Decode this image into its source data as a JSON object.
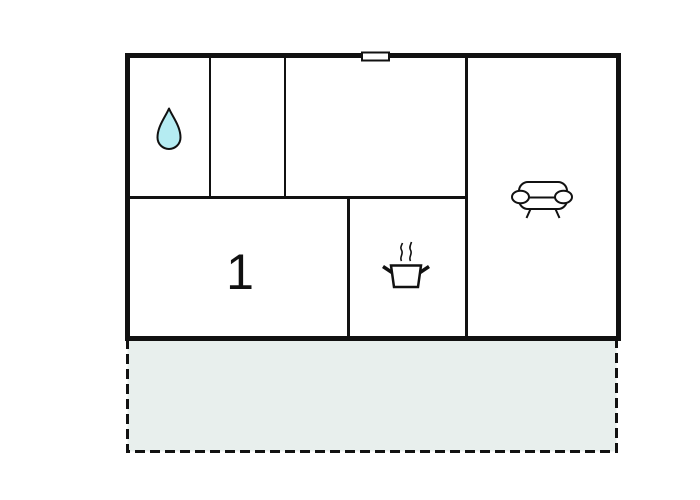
{
  "floorplan": {
    "bedroom_label": "1",
    "icons": [
      "water-drop-icon",
      "cooking-pot-icon",
      "sofa-icon"
    ],
    "areas": {
      "indoor_rooms_count": 5,
      "outdoor_area": "dashed terrace"
    }
  },
  "colors": {
    "wall": "#111111",
    "water_drop_fill": "#b5ecf2",
    "terrace_fill": "#e8efed",
    "background": "#ffffff"
  }
}
